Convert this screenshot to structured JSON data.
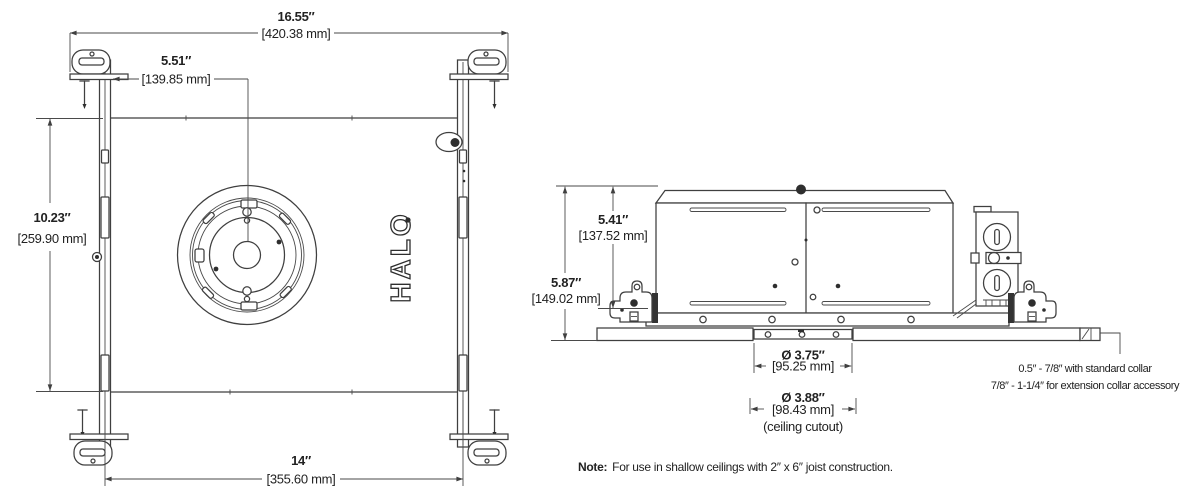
{
  "brand": {
    "logo": "HALO"
  },
  "plan_view": {
    "overall_width_in": "16.55″",
    "overall_width_mm": "[420.38 mm]",
    "center_offset_in": "5.51″",
    "center_offset_mm": "[139.85 mm]",
    "height_in": "10.23″",
    "height_mm": "[259.90 mm]",
    "base_width_in": "14″",
    "base_width_mm": "[355.60 mm]"
  },
  "side_view": {
    "housing_height_in": "5.41″",
    "housing_height_mm": "[137.52 mm]",
    "overall_height_in": "5.87″",
    "overall_height_mm": "[149.02 mm]",
    "aperture_dia_in": "Ø 3.75″",
    "aperture_dia_mm": "[95.25 mm]",
    "cutout_dia_in": "Ø 3.88″",
    "cutout_dia_mm": "[98.43 mm]",
    "cutout_caption": "(ceiling cutout)",
    "collar_range_standard": "0.5″ - 7/8″ with standard collar",
    "collar_range_extension": "7/8″ - 1-1/4″ for extension collar accessory"
  },
  "note": {
    "label": "Note:",
    "text": "For use in shallow ceilings with 2″ x 6″ joist construction."
  }
}
